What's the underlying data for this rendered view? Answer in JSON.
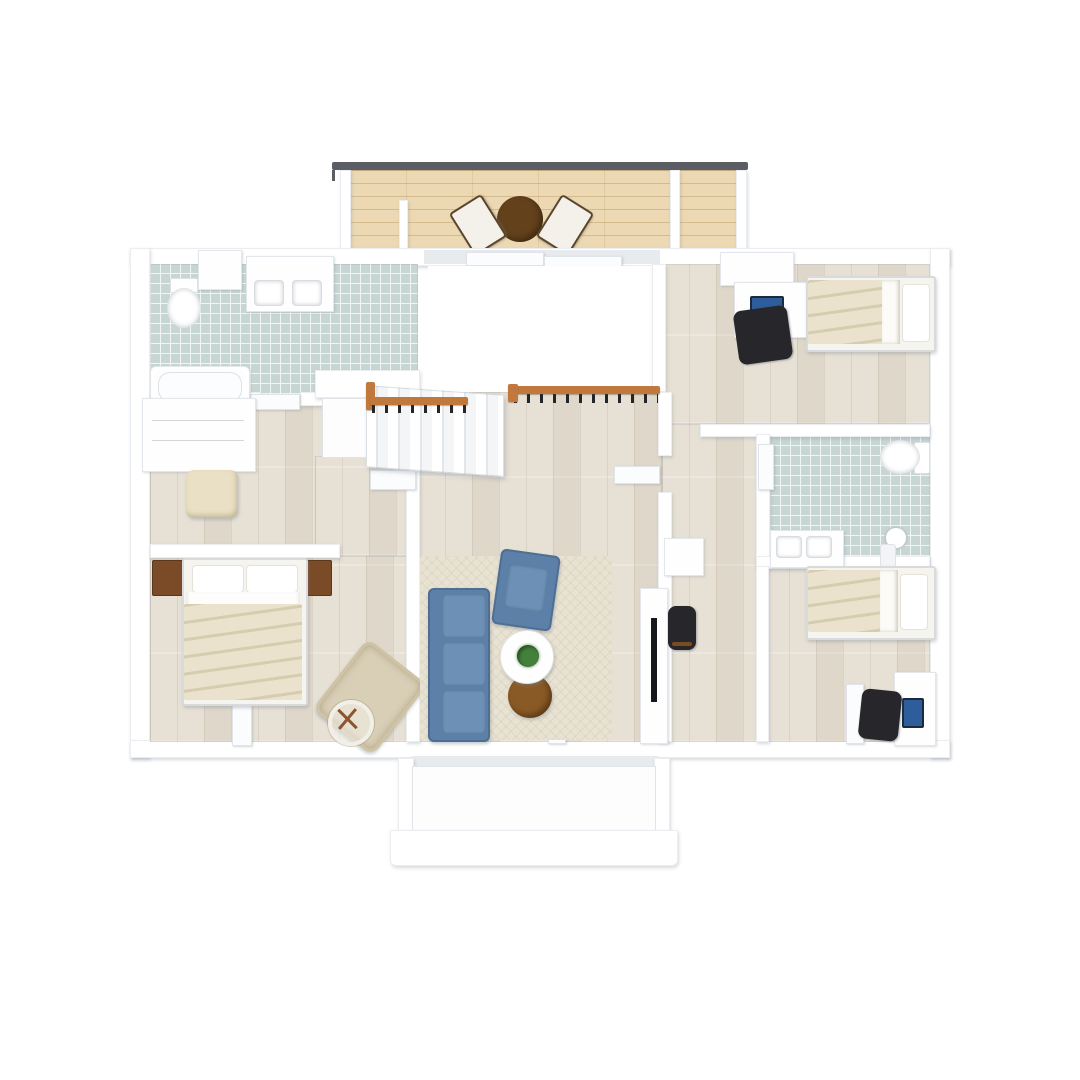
{
  "scene": {
    "type": "3d-floor-plan-top-view",
    "floor": "upper floor with staircase void",
    "background": "#ffffff"
  },
  "palette": {
    "wall": "#ffffff",
    "wall_shadow": "#dfe3e7",
    "wood_floor": "#e7e1d5",
    "tile_base": "#c7d6d3",
    "deck_base": "#ecd9b3",
    "railing_dark": "#5a5e64",
    "stair_rail_wood": "#c0783c",
    "baluster": "#22252a",
    "sofa_blue": "#5c80a7",
    "sofa_blue_light": "#6d90b6",
    "rug": "#e8e2d2",
    "side_table_brown": "#8a5a26",
    "plant_green": "#44803c",
    "bedding_cream": "#eae2cc",
    "nightstand_brown": "#7b4a26",
    "chair_beige": "#d9cfb6",
    "black_chair": "#26262b",
    "monitor_blue": "#2e5d9c"
  },
  "rooms": [
    {
      "id": "top-balcony",
      "kind": "balcony",
      "flooring": "wood-deck",
      "furniture": [
        "round-patio-table",
        "lounge-chair",
        "lounge-chair"
      ],
      "features": [
        "metal-railing"
      ]
    },
    {
      "id": "bathroom-top-left",
      "kind": "bathroom",
      "flooring": "blue-green-tile",
      "furniture": [
        "toilet",
        "double-sink-vanity",
        "bathtub",
        "wall-cabinet"
      ]
    },
    {
      "id": "walk-in-closet",
      "kind": "closet",
      "flooring": "light-wood",
      "furniture": [
        "wardrobe-shelves",
        "ottoman"
      ]
    },
    {
      "id": "master-bedroom",
      "kind": "bedroom",
      "flooring": "light-wood",
      "furniture": [
        "double-bed",
        "nightstand",
        "nightstand",
        "beige-armchair",
        "floor-fan"
      ]
    },
    {
      "id": "staircase",
      "kind": "stairs",
      "flooring": "white-stairs",
      "features": [
        "wood-handrail",
        "black-balusters",
        "open-void-to-below"
      ]
    },
    {
      "id": "living-room",
      "kind": "living",
      "flooring": "light-wood",
      "furniture": [
        "blue-three-seat-sofa",
        "blue-armchair",
        "white-round-coffee-table",
        "potted-plant",
        "brown-round-side-table",
        "area-rug",
        "tv-console",
        "wall-tv"
      ]
    },
    {
      "id": "hallway",
      "kind": "hall",
      "flooring": "light-wood",
      "furniture": [
        "wall-shelf",
        "black-stool"
      ]
    },
    {
      "id": "bedroom-top-right",
      "kind": "bedroom",
      "flooring": "light-wood",
      "furniture": [
        "single-bed",
        "desk",
        "computer-monitor",
        "black-office-chair",
        "dresser"
      ]
    },
    {
      "id": "bathroom-right",
      "kind": "bathroom",
      "flooring": "blue-green-tile",
      "furniture": [
        "toilet",
        "double-sink-vanity",
        "shower-fixture"
      ]
    },
    {
      "id": "bedroom-bottom-right",
      "kind": "bedroom",
      "flooring": "light-wood",
      "furniture": [
        "single-bed",
        "desk",
        "computer-monitor",
        "black-office-chair"
      ]
    },
    {
      "id": "bottom-balcony",
      "kind": "balcony",
      "flooring": "white",
      "features": [
        "white-parapet-walls"
      ]
    }
  ]
}
